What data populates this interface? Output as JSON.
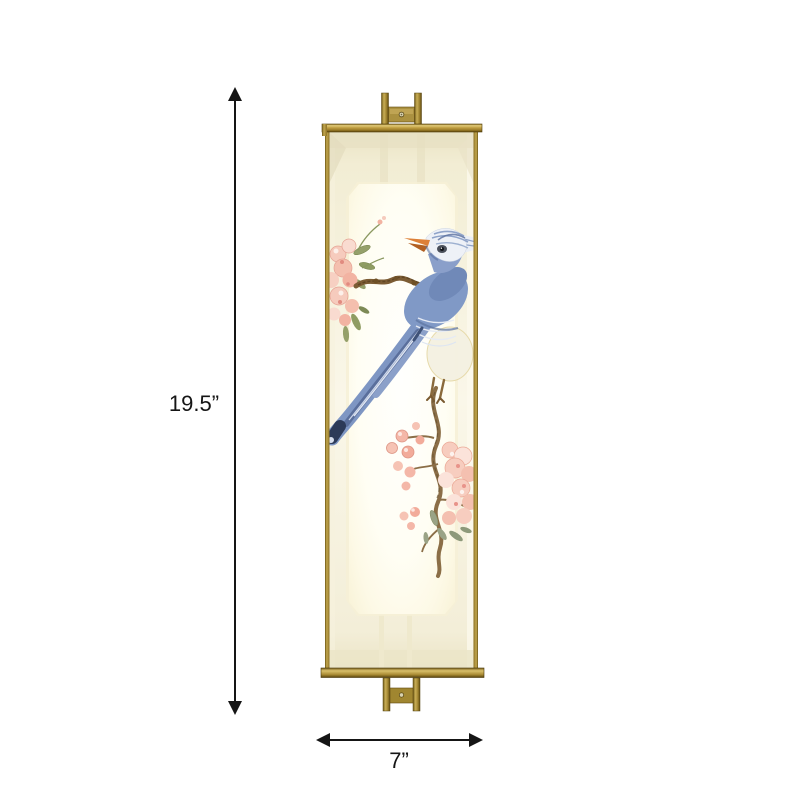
{
  "image": {
    "type": "product-dimension-diagram",
    "background": "#ffffff"
  },
  "dimensions": {
    "height_label": "19.5”",
    "width_label": "7”"
  },
  "icons": {
    "height_arrow": "double-headed-vertical-arrow",
    "width_arrow": "double-headed-horizontal-arrow"
  },
  "colors": {
    "annotation": "#151515",
    "frame_brass": "#b09339",
    "frame_brass_dark": "#6e5513",
    "frame_brass_light": "#e0c97e",
    "bracket_brass": "#ab9140",
    "shade_fabric": "#f6f2dd",
    "light_panel": "#fffef6",
    "bird_blue": "#8099c6",
    "bird_blue_dark": "#54699a",
    "beak_orange": "#d97a35",
    "blossom_pink": "#f4c4b6",
    "blossom_deep_pink": "#e8938a",
    "leaf_green": "#8f9c62",
    "leaf_gray_green": "#9aa386",
    "branch_brown": "#8b6e47"
  }
}
